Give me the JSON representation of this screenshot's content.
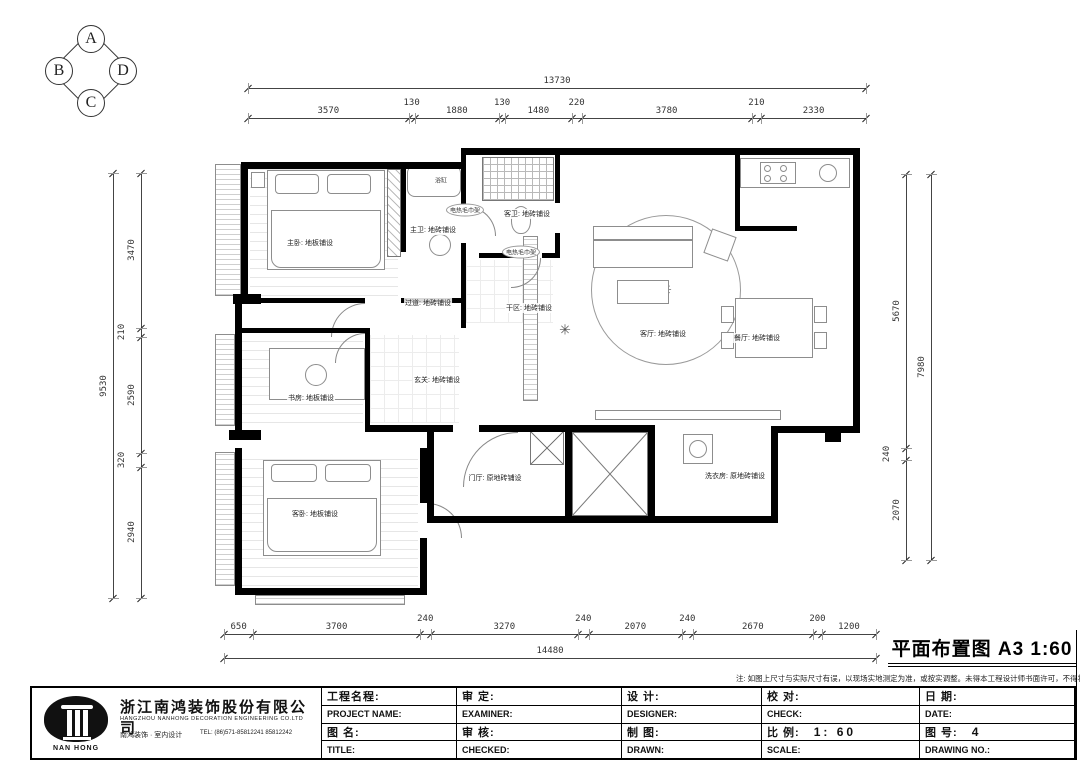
{
  "compass": {
    "top": "A",
    "left": "B",
    "right": "D",
    "bottom": "C"
  },
  "drawing_title": {
    "text": "平面布置图  A3  1:60"
  },
  "note": "注: 如图上尺寸与实际尺寸有误，以现场实地测定为准，或按实调整。未得本工程设计师书面许可，不得将任何部分翻印。",
  "dimensions": {
    "top_overall": "13730",
    "top_segments": [
      "3570",
      "130",
      "1880",
      "130",
      "1480",
      "220",
      "3780",
      "210",
      "2330"
    ],
    "left_overall": "9530",
    "left_segments": [
      "3470",
      "210",
      "2590",
      "320",
      "2940"
    ],
    "right_overall": "7980",
    "right_segments": [
      "5670",
      "240",
      "2070"
    ],
    "bottom_overall": "14480",
    "bottom_segments": [
      "650",
      "3700",
      "240",
      "3270",
      "240",
      "2070",
      "240",
      "2670",
      "200",
      "1200"
    ]
  },
  "rooms": [
    {
      "id": "master-bedroom",
      "label": "主卧: 地板铺设"
    },
    {
      "id": "master-bath",
      "label": "主卫: 地砖铺设"
    },
    {
      "id": "guest-bath",
      "label": "客卫: 地砖铺设"
    },
    {
      "id": "hallway",
      "label": "过道: 地砖铺设"
    },
    {
      "id": "dry-area",
      "label": "干区: 地砖铺设"
    },
    {
      "id": "entry",
      "label": "玄关: 地砖铺设"
    },
    {
      "id": "living-room",
      "label": "客厅: 地砖铺设"
    },
    {
      "id": "dining-room",
      "label": "餐厅: 地砖铺设"
    },
    {
      "id": "study",
      "label": "书房: 地板铺设"
    },
    {
      "id": "guest-bedroom",
      "label": "客卧: 地板铺设"
    },
    {
      "id": "foyer",
      "label": "门厅: 原地砖铺设"
    },
    {
      "id": "laundry",
      "label": "洗衣房: 原地砖铺设"
    }
  ],
  "fixtures": [
    {
      "id": "bathtub",
      "label": "浴缸",
      "style": "plain"
    },
    {
      "id": "towel-rack-1",
      "label": "电热毛巾架",
      "style": "bubble"
    },
    {
      "id": "towel-rack-2",
      "label": "电热毛巾架",
      "style": "bubble"
    }
  ],
  "title_block": {
    "company": {
      "logo_text": "NAN HONG",
      "name_cn": "浙江南鸿装饰股份有限公司",
      "name_en": "HANGZHOU NANHONG DECORATION ENGINEERING CO.LTD",
      "sub": "南鸿装饰 · 室内设计",
      "tel": "TEL: (86)571-85812241 85812242"
    },
    "col1": {
      "r1": "工程名程:",
      "r2": "PROJECT NAME:",
      "r3": "图 名:",
      "r4": "TITLE:"
    },
    "col2": {
      "r1": "审  定:",
      "r2": "EXAMINER:",
      "r3": "审  核:",
      "r4": "CHECKED:"
    },
    "col3": {
      "r1": "设  计:",
      "r2": "DESIGNER:",
      "r3": "制  图:",
      "r4": "DRAWN:"
    },
    "col4": {
      "r1": "校  对:",
      "r2": "CHECK:",
      "r3": "比  例:",
      "r3_value": "1: 60",
      "r4": "SCALE:"
    },
    "col5": {
      "r1": "日  期:",
      "r2": "DATE:",
      "r3": "图  号:",
      "r3_value": "4",
      "r4": "DRAWING NO.:"
    }
  }
}
